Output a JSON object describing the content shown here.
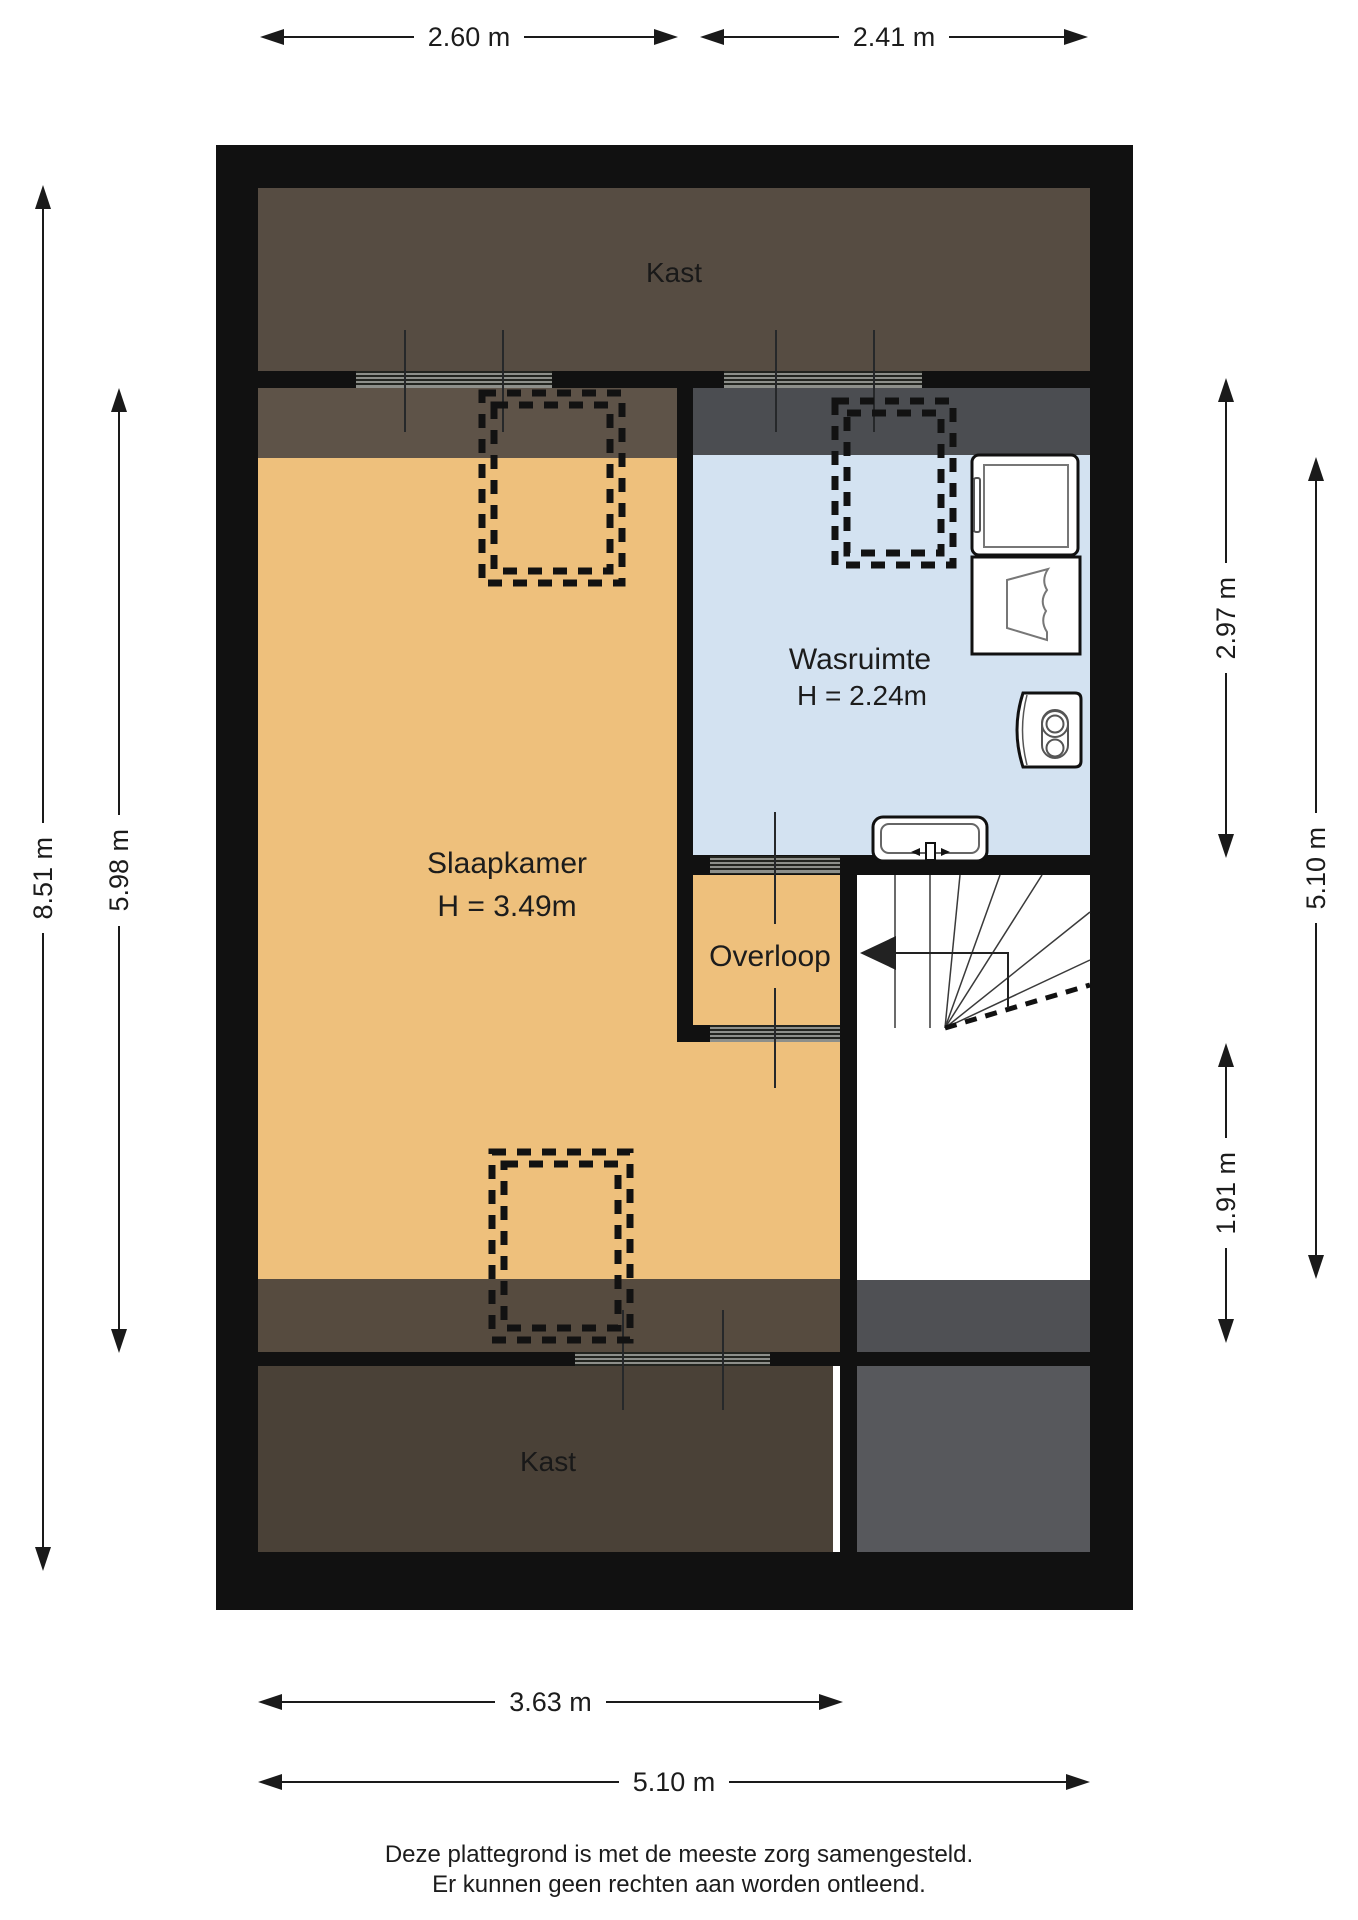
{
  "rooms": {
    "kast_top": {
      "name": "Kast"
    },
    "slaapkamer": {
      "name": "Slaapkamer",
      "height": "H = 3.49m"
    },
    "wasruimte": {
      "name": "Wasruimte",
      "height": "H = 2.24m"
    },
    "overloop": {
      "name": "Overloop"
    },
    "kast_bottom": {
      "name": "Kast"
    }
  },
  "dimensions": {
    "top": [
      {
        "label": "2.60 m"
      },
      {
        "label": "2.41 m"
      }
    ],
    "left": [
      {
        "label": "8.51 m"
      },
      {
        "label": "5.98 m"
      }
    ],
    "right": [
      {
        "label": "2.97 m"
      },
      {
        "label": "5.10 m"
      },
      {
        "label": "1.91 m"
      }
    ],
    "bottom": [
      {
        "label": "3.63 m"
      },
      {
        "label": "5.10 m"
      }
    ]
  },
  "footer": {
    "line1": "Deze plattegrond is met de meeste zorg samengesteld.",
    "line2": "Er kunnen geen rechten aan worden ontleend."
  },
  "icons": {
    "stairs": "stairs-with-direction-arrow",
    "washer": "washing-machine-icon",
    "basket": "laundry-basket-icon",
    "boiler": "boiler-icon",
    "sink": "sink-icon",
    "dormer": "dashed-roofwindow-outline"
  },
  "colors": {
    "wall": "#111111",
    "orange": "#eec07c",
    "blue": "#d3e2f1",
    "kastTop": "#564c42",
    "stripTopLeft": "#5e5348",
    "stripTopRight": "#4b4d51",
    "stripBottomLeft": "#564b3f",
    "stripBottomRight": "#4f5054",
    "kastBottom": "#4a4137",
    "grayBottom": "#57585c"
  }
}
